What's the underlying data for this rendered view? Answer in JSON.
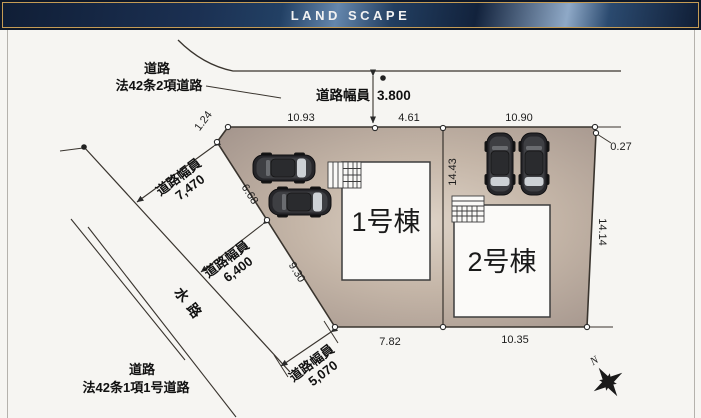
{
  "header": {
    "title": "LAND SCAPE"
  },
  "site_plan": {
    "buildings": [
      {
        "label": "1号棟"
      },
      {
        "label": "2号棟"
      }
    ],
    "roads": {
      "north_road": {
        "line1": "道路",
        "line2": "法42条2項道路"
      },
      "southwest_road": {
        "line1": "道路",
        "line2": "法42条1項1号道路"
      },
      "waterway": "水路"
    },
    "road_widths": {
      "north": {
        "label": "道路幅員",
        "value": "3.800"
      },
      "w7470": {
        "label": "道路幅員",
        "value": "7,470"
      },
      "w6400": {
        "label": "道路幅員",
        "value": "6,400"
      },
      "w5070": {
        "label": "道路幅員",
        "value": "5,070"
      }
    },
    "dimensions": {
      "top_left": "10.93",
      "top_mid": "4.61",
      "top_right": "10.90",
      "corner_top_left": "1.24",
      "corner_top_right": "0.27",
      "left_upper": "6.68",
      "left_lower": "9.30",
      "divider": "14.43",
      "right": "14.14",
      "bottom_left": "7.82",
      "bottom_right": "10.35"
    },
    "compass": {
      "north": "N"
    }
  },
  "colors": {
    "header_navy": "#1b3052",
    "header_gold": "#c59c55",
    "plot_fill": "#baab9d",
    "plot_fill_light": "#dbd0c4",
    "line": "#39342e",
    "building_fill": "#fbfaf8"
  }
}
